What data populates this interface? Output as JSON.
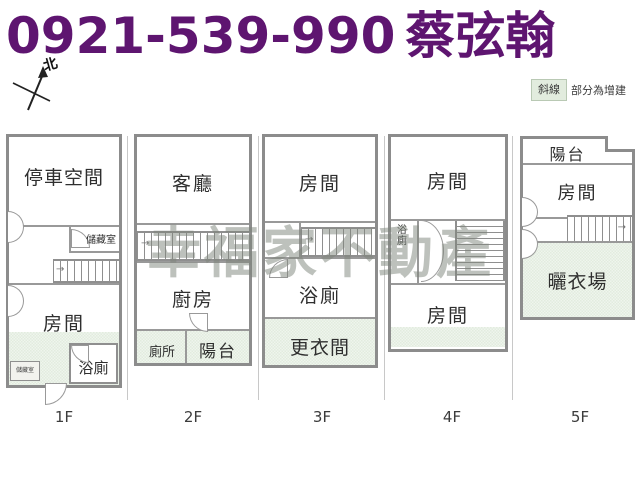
{
  "header": {
    "phone": "0921-539-990",
    "agent": "蔡弦翰",
    "text_color": "#5e1570"
  },
  "compass": {
    "north_label": "北"
  },
  "legend": {
    "swatch_label": "斜線",
    "description": "部分為增建",
    "swatch_color": "#e2ecde"
  },
  "watermark": {
    "text": "幸福家不動產",
    "color": "#7e857b"
  },
  "colors": {
    "wall_gray": "#8c8c8c",
    "annex_green": "#e2ecde",
    "header_purple": "#5e1570"
  },
  "floors": {
    "f1": {
      "tag": "1F",
      "parking": "停車空間",
      "storage": "儲藏室",
      "room": "房間",
      "bath": "浴廁",
      "storage_small": "儲藏室"
    },
    "f2": {
      "tag": "2F",
      "living": "客廳",
      "kitchen": "廚房",
      "toilet": "廁所",
      "balcony": "陽台"
    },
    "f3": {
      "tag": "3F",
      "room": "房間",
      "bath": "浴廁",
      "dressing": "更衣間"
    },
    "f4": {
      "tag": "4F",
      "room_top": "房間",
      "bath": "浴廁",
      "room_bottom": "房間"
    },
    "f5": {
      "tag": "5F",
      "balcony": "陽台",
      "room": "房間",
      "drying": "曬衣場"
    }
  }
}
